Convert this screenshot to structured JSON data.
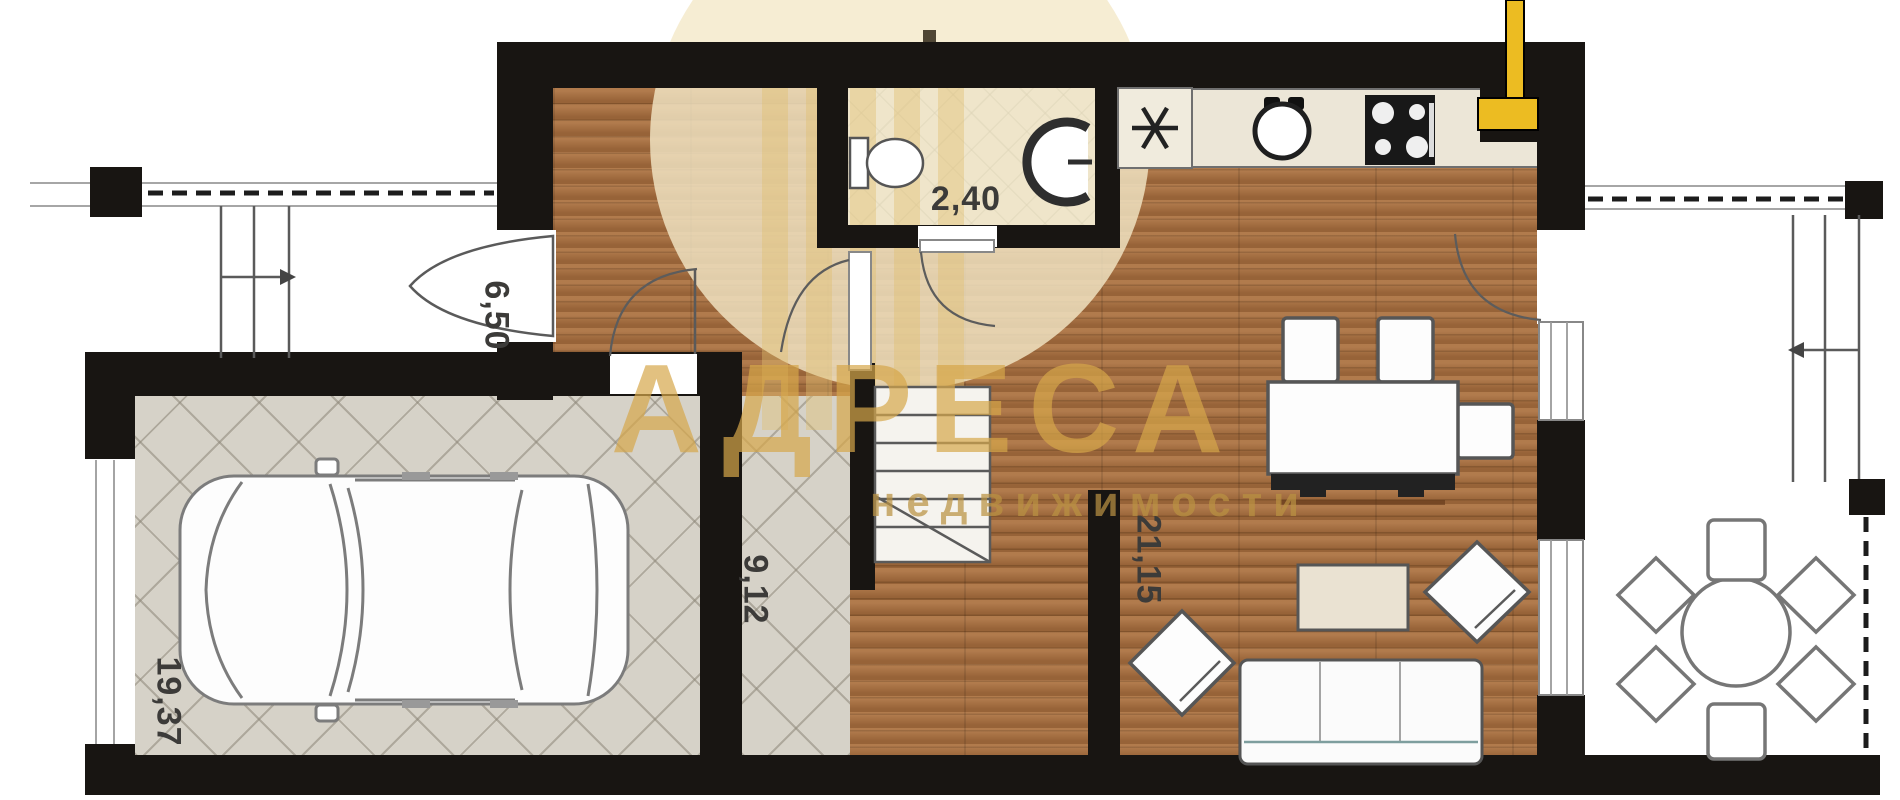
{
  "watermark": {
    "brand": "АДРЕСА",
    "subtitle": "недвижимости"
  },
  "rooms": {
    "entry_hall": {
      "area": "6,50"
    },
    "wc": {
      "area": "2,40"
    },
    "stair_hall": {
      "area": "9,12"
    },
    "living_kitchen": {
      "area": "21,15"
    },
    "garage": {
      "area": "19,37"
    }
  },
  "colors": {
    "wall": "#181512",
    "wood": "#a86e3e",
    "tile": "#d6d2c8",
    "accent": "#d5a64f",
    "chimney": "#ecbc22",
    "label": "#3c3b39"
  }
}
